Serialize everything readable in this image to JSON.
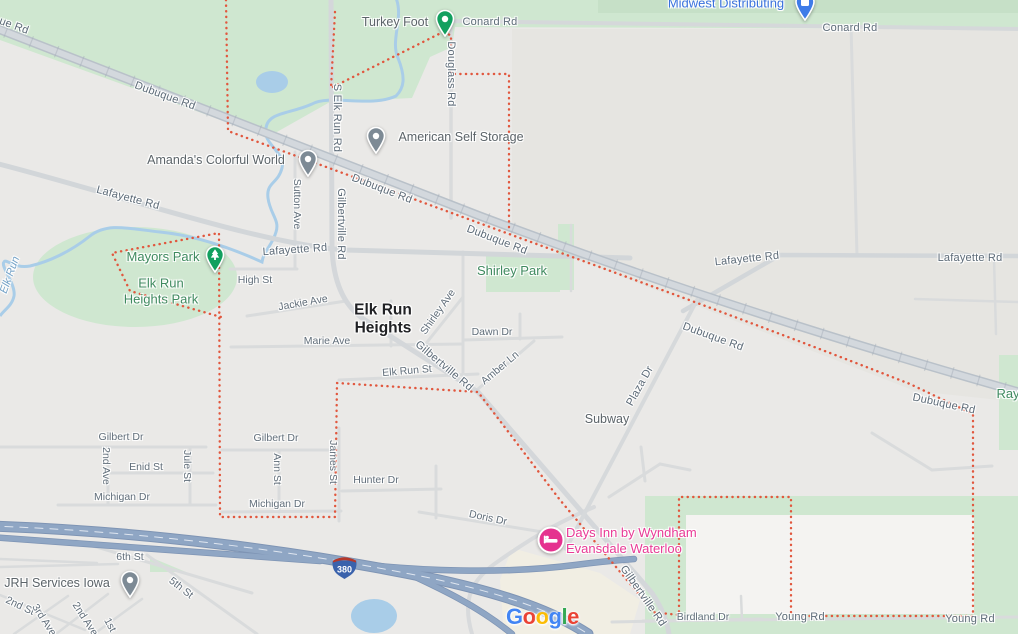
{
  "map": {
    "place_shown": "Elk Run Heights",
    "colors": {
      "background": "#eae9e7",
      "outside_tint": "#e6e5e1",
      "park_green": "#cfe7d0",
      "forest_green_dark": "#c6e0c7",
      "water_blue": "#a9cde8",
      "highway_blue": "#8fa6c4",
      "boundary_red": "#e1573e",
      "hotel_pink": "#e93a96",
      "business_blue": "#3a72dd"
    }
  },
  "shield": {
    "route": "380"
  },
  "google_logo": {
    "letters": [
      [
        "G",
        "#4285F4"
      ],
      [
        "o",
        "#EA4335"
      ],
      [
        "o",
        "#FBBC05"
      ],
      [
        "g",
        "#4285F4"
      ],
      [
        "l",
        "#34A853"
      ],
      [
        "e",
        "#EA4335"
      ]
    ]
  },
  "labels": [
    {
      "name": "road-label-dubuque-edge",
      "text": "ue Rd",
      "x": 14,
      "y": 26,
      "rot": 20,
      "cls": "road",
      "inter": false
    },
    {
      "name": "road-label-dubuque-1",
      "text": "Dubuque Rd",
      "x": 165,
      "y": 96,
      "rot": 20,
      "cls": "road",
      "inter": false
    },
    {
      "name": "road-label-dubuque-2",
      "text": "Dubuque Rd",
      "x": 382,
      "y": 189,
      "rot": 21,
      "cls": "road",
      "inter": false
    },
    {
      "name": "road-label-dubuque-3",
      "text": "Dubuque Rd",
      "x": 497,
      "y": 240,
      "rot": 21,
      "cls": "road",
      "inter": false
    },
    {
      "name": "road-label-dubuque-4",
      "text": "Dubuque Rd",
      "x": 713,
      "y": 337,
      "rot": 20,
      "cls": "road",
      "inter": false
    },
    {
      "name": "road-label-dubuque-5",
      "text": "Dubuque Rd",
      "x": 944,
      "y": 404,
      "rot": 12,
      "cls": "road",
      "inter": false
    },
    {
      "name": "road-label-lafayette-1",
      "text": "Lafayette Rd",
      "x": 128,
      "y": 198,
      "rot": 15,
      "cls": "road",
      "inter": false
    },
    {
      "name": "road-label-lafayette-2",
      "text": "Lafayette Rd",
      "x": 295,
      "y": 250,
      "rot": -4,
      "cls": "road",
      "inter": false
    },
    {
      "name": "road-label-lafayette-3",
      "text": "Lafayette Rd",
      "x": 747,
      "y": 259,
      "rot": -6,
      "cls": "road",
      "inter": false
    },
    {
      "name": "road-label-lafayette-4",
      "text": "Lafayette Rd",
      "x": 970,
      "y": 258,
      "rot": 0,
      "cls": "road",
      "inter": false
    },
    {
      "name": "road-label-conard-1",
      "text": "Conard Rd",
      "x": 490,
      "y": 22,
      "rot": 0,
      "cls": "road",
      "inter": false
    },
    {
      "name": "road-label-conard-2",
      "text": "Conard Rd",
      "x": 850,
      "y": 28,
      "rot": 0,
      "cls": "road",
      "inter": false
    },
    {
      "name": "road-label-s-elk-run-rd",
      "text": "S Elk Run Rd",
      "x": 337,
      "y": 118,
      "rot": 90,
      "cls": "road",
      "inter": false
    },
    {
      "name": "road-label-douglass-rd",
      "text": "Douglass Rd",
      "x": 451,
      "y": 74,
      "rot": 90,
      "cls": "road",
      "inter": false
    },
    {
      "name": "road-label-gilbertville-n",
      "text": "Gilbertville Rd",
      "x": 341,
      "y": 224,
      "rot": 90,
      "cls": "road",
      "inter": false
    },
    {
      "name": "street-label-sutton-ave",
      "text": "Sutton Ave",
      "x": 297,
      "y": 204,
      "rot": 90,
      "cls": "st",
      "inter": false
    },
    {
      "name": "street-label-high-st",
      "text": "High St",
      "x": 255,
      "y": 280,
      "rot": 0,
      "cls": "st",
      "inter": false
    },
    {
      "name": "street-label-jackie-ave",
      "text": "Jackie Ave",
      "x": 303,
      "y": 303,
      "rot": -10,
      "cls": "st",
      "inter": false
    },
    {
      "name": "street-label-marie-ave",
      "text": "Marie Ave",
      "x": 327,
      "y": 341,
      "rot": 0,
      "cls": "st",
      "inter": false
    },
    {
      "name": "street-label-elk-run-st",
      "text": "Elk Run St",
      "x": 407,
      "y": 371,
      "rot": -5,
      "cls": "st",
      "inter": false
    },
    {
      "name": "street-label-shirley-ave",
      "text": "Shirley Ave",
      "x": 438,
      "y": 312,
      "rot": -55,
      "cls": "st",
      "inter": false
    },
    {
      "name": "street-label-dawn-dr",
      "text": "Dawn Dr",
      "x": 492,
      "y": 332,
      "rot": 0,
      "cls": "st",
      "inter": false
    },
    {
      "name": "street-label-amber-ln",
      "text": "Amber Ln",
      "x": 500,
      "y": 368,
      "rot": -40,
      "cls": "st",
      "inter": false
    },
    {
      "name": "road-label-gilbertville-mid",
      "text": "Gilbertville Rd",
      "x": 444,
      "y": 366,
      "rot": 40,
      "cls": "road",
      "inter": false
    },
    {
      "name": "road-label-plaza-dr",
      "text": "Plaza Dr",
      "x": 640,
      "y": 386,
      "rot": -61,
      "cls": "road",
      "inter": false
    },
    {
      "name": "road-label-gilbertville-s",
      "text": "Gilbertville Rd",
      "x": 643,
      "y": 596,
      "rot": 55,
      "cls": "road",
      "inter": false
    },
    {
      "name": "street-label-gilbert-dr-1",
      "text": "Gilbert Dr",
      "x": 121,
      "y": 437,
      "rot": 0,
      "cls": "st",
      "inter": false
    },
    {
      "name": "street-label-gilbert-dr-2",
      "text": "Gilbert Dr",
      "x": 276,
      "y": 438,
      "rot": 0,
      "cls": "st",
      "inter": false
    },
    {
      "name": "street-label-2nd-ave",
      "text": "2nd Ave",
      "x": 106,
      "y": 466,
      "rot": 90,
      "cls": "st",
      "inter": false
    },
    {
      "name": "street-label-enid-st",
      "text": "Enid St",
      "x": 146,
      "y": 467,
      "rot": 0,
      "cls": "st",
      "inter": false
    },
    {
      "name": "street-label-jule-st",
      "text": "Jule St",
      "x": 187,
      "y": 466,
      "rot": 90,
      "cls": "st",
      "inter": false
    },
    {
      "name": "street-label-michigan-dr-1",
      "text": "Michigan Dr",
      "x": 122,
      "y": 497,
      "rot": 0,
      "cls": "st",
      "inter": false
    },
    {
      "name": "street-label-ann-st",
      "text": "Ann St",
      "x": 277,
      "y": 469,
      "rot": 90,
      "cls": "st",
      "inter": false
    },
    {
      "name": "street-label-michigan-dr-2",
      "text": "Michigan Dr",
      "x": 277,
      "y": 504,
      "rot": 0,
      "cls": "st",
      "inter": false
    },
    {
      "name": "street-label-james-st",
      "text": "James St",
      "x": 333,
      "y": 462,
      "rot": 90,
      "cls": "st",
      "inter": false
    },
    {
      "name": "street-label-hunter-dr",
      "text": "Hunter Dr",
      "x": 376,
      "y": 480,
      "rot": 0,
      "cls": "st",
      "inter": false
    },
    {
      "name": "street-label-doris-dr",
      "text": "Doris Dr",
      "x": 488,
      "y": 518,
      "rot": 12,
      "cls": "st",
      "inter": false
    },
    {
      "name": "street-label-birdland-dr",
      "text": "Birdland Dr",
      "x": 703,
      "y": 617,
      "rot": 0,
      "cls": "st",
      "inter": false
    },
    {
      "name": "road-label-young-rd-1",
      "text": "Young Rd",
      "x": 800,
      "y": 617,
      "rot": 0,
      "cls": "road",
      "inter": false
    },
    {
      "name": "road-label-young-rd-2",
      "text": "Young Rd",
      "x": 970,
      "y": 619,
      "rot": 0,
      "cls": "road",
      "inter": false
    },
    {
      "name": "street-label-6th-st",
      "text": "6th St",
      "x": 130,
      "y": 557,
      "rot": 0,
      "cls": "st",
      "inter": false
    },
    {
      "name": "street-label-5th-st",
      "text": "5th St",
      "x": 181,
      "y": 588,
      "rot": 38,
      "cls": "st",
      "inter": false
    },
    {
      "name": "street-label-2nd-st",
      "text": "2nd St",
      "x": 20,
      "y": 606,
      "rot": 25,
      "cls": "st",
      "inter": false
    },
    {
      "name": "street-label-3rd-ave",
      "text": "3rd Ave",
      "x": 44,
      "y": 620,
      "rot": 57,
      "cls": "st",
      "inter": false
    },
    {
      "name": "street-label-2nd-ave-s",
      "text": "2nd Ave",
      "x": 85,
      "y": 619,
      "rot": 57,
      "cls": "st",
      "inter": false
    },
    {
      "name": "street-label-1st",
      "text": "1st",
      "x": 110,
      "y": 625,
      "rot": 62,
      "cls": "st",
      "inter": false
    },
    {
      "name": "city-label-elk-run-heights",
      "lines": [
        "Elk Run",
        "Heights"
      ],
      "x": 383,
      "y": 320,
      "rot": 0,
      "cls": "city",
      "inter": true
    },
    {
      "name": "park-label-mayors-park",
      "text": "Mayors Park",
      "x": 163,
      "y": 257,
      "rot": 0,
      "cls": "park",
      "inter": true
    },
    {
      "name": "park-label-elk-run-heights-park",
      "lines": [
        "Elk Run",
        "Heights Park"
      ],
      "x": 161,
      "y": 291,
      "rot": 0,
      "cls": "park",
      "inter": true
    },
    {
      "name": "park-label-shirley-park",
      "text": "Shirley Park",
      "x": 512,
      "y": 271,
      "rot": 0,
      "cls": "park",
      "inter": true
    },
    {
      "name": "park-label-ray",
      "text": "Ray",
      "x": 1008,
      "y": 394,
      "rot": 0,
      "cls": "park",
      "inter": true
    },
    {
      "name": "poi-label-turkey-foot",
      "text": "Turkey Foot",
      "x": 395,
      "y": 22,
      "rot": 0,
      "cls": "poi",
      "inter": true
    },
    {
      "name": "poi-label-american-self-storage",
      "text": "American Self Storage",
      "x": 461,
      "y": 137,
      "rot": 0,
      "cls": "poi",
      "inter": true
    },
    {
      "name": "poi-label-amandas-colorful-world",
      "text": "Amanda's Colorful World",
      "x": 216,
      "y": 160,
      "rot": 0,
      "cls": "poi",
      "inter": true
    },
    {
      "name": "poi-label-subway",
      "text": "Subway",
      "x": 607,
      "y": 419,
      "rot": 0,
      "cls": "poi",
      "inter": true
    },
    {
      "name": "poi-label-jrh-services-iowa",
      "text": "JRH Services Iowa",
      "x": 57,
      "y": 583,
      "rot": 0,
      "cls": "poi",
      "inter": true
    },
    {
      "name": "biz-label-midwest-distributing",
      "text": "Midwest Distributing",
      "x": 726,
      "y": 3,
      "rot": 0,
      "cls": "biz",
      "inter": true
    },
    {
      "name": "hotel-label-days-inn",
      "lines": [
        "Days Inn by Wyndham",
        "Evansdale Waterloo"
      ],
      "x": 566,
      "y": 541,
      "rot": 0,
      "cls": "hotel",
      "align": "left",
      "inter": true
    },
    {
      "name": "water-label-elk-run",
      "text": "Elk Run",
      "x": 10,
      "y": 275,
      "rot": -70,
      "cls": "water",
      "inter": false
    }
  ],
  "markers": [
    {
      "name": "turkey-foot-pin",
      "type": "poi-green",
      "x": 445,
      "y": 19
    },
    {
      "name": "mayors-park-tree-pin",
      "type": "park-tree",
      "x": 215,
      "y": 255
    },
    {
      "name": "amandas-colorful-world-pin",
      "type": "poi-gray",
      "x": 308,
      "y": 159
    },
    {
      "name": "american-self-storage-pin",
      "type": "poi-gray",
      "x": 376,
      "y": 136
    },
    {
      "name": "jrh-services-pin",
      "type": "poi-gray",
      "x": 130,
      "y": 580
    },
    {
      "name": "midwest-distributing-pin",
      "type": "biz-blue",
      "x": 805,
      "y": 2
    },
    {
      "name": "days-inn-pin",
      "type": "hotel-pink",
      "x": 551,
      "y": 540
    }
  ]
}
